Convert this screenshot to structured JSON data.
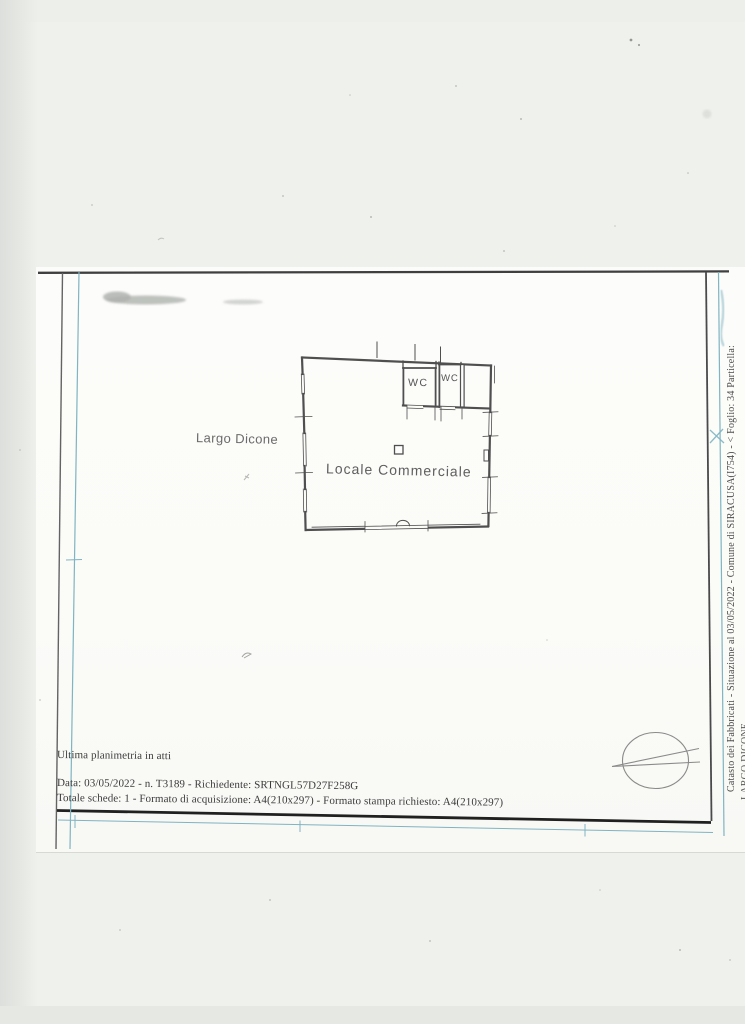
{
  "plan": {
    "street_label": "Largo Dicone",
    "room_label": "Locale Commerciale",
    "wc_left_label": "WC",
    "wc_right_label": "WC"
  },
  "footer": {
    "line1": "Ultima planimetria in atti",
    "line2": "Data: 03/05/2022 - n. T3189 - Richiedente: SRTNGL57D27F258G",
    "line3": "Totale schede: 1 - Formato di acquisizione: A4(210x297)  - Formato stampa richiesto: A4(210x297)"
  },
  "side_text": {
    "line1": "Catasto dei Fabbricati - Situazione al 03/05/2022 - Comune di SIRACUSA(I754) - < Foglio: 34 Particella:",
    "line2": "LARGO DICONE"
  },
  "colors": {
    "frame_blue": "#7fb4c1",
    "ink": "#3d3d3d",
    "paper": "#fbfbf9",
    "scanner_background": "#eef0ec"
  }
}
